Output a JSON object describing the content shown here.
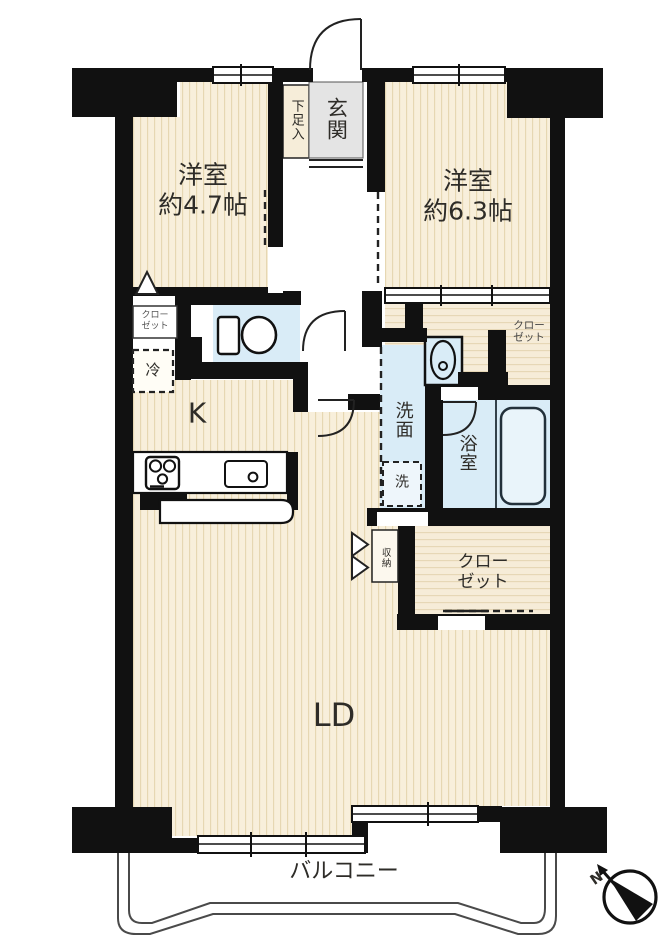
{
  "plan": {
    "rooms": {
      "west_bedroom": {
        "label": "洋室",
        "size": "約4.7帖"
      },
      "east_bedroom": {
        "label": "洋室",
        "size": "約6.3帖"
      },
      "kitchen": {
        "label": "K"
      },
      "living_dining": {
        "label": "LD"
      },
      "balcony": {
        "label": "バルコニー"
      },
      "entrance": {
        "label": "玄関"
      },
      "shoe_cabinet": {
        "label": "下足入"
      },
      "washroom": {
        "label": "洗面"
      },
      "washer_space": {
        "label": "洗"
      },
      "bathroom": {
        "label": "浴室"
      },
      "refrigerator_space": {
        "label": "冷"
      },
      "storage": {
        "label": "収納"
      },
      "closet_west": {
        "line1": "クロー",
        "line2": "ゼット"
      },
      "closet_east_upper": {
        "line1": "クロー",
        "line2": "ゼット"
      },
      "closet_south": {
        "line1": "クロー",
        "line2": "ゼット"
      }
    },
    "compass": {
      "label": "N"
    },
    "colors": {
      "wall": "#111111",
      "floor": "#f8efdb",
      "floor_stripe": "#e6d6b0",
      "wet_area": "#d9ecf7",
      "entrance_floor": "#e4e4e4"
    }
  }
}
